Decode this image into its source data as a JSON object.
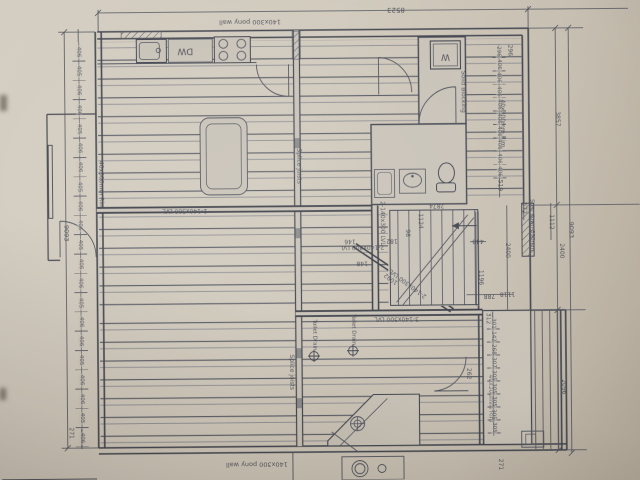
{
  "labels": {
    "pony_wall_top": "140x300 pony wall",
    "pony_wall_bottom": "140x300 pony wall",
    "splice_joists_upper": "Splice joists",
    "splice_joists_lower": "Splice joists",
    "rim_left": "40x300mm Rim",
    "rim_right_upper": "40x300mm Rim",
    "rim_right_lower": "40x300mm Rim",
    "solid_blocking": "Solid Blocking",
    "lvl_beam_mid": "2-140x300 LVL",
    "lvl_beam_stair": "2-140x300 LVL",
    "lvl_beam_vertical": "2-140x300 LVL",
    "lvl_beam_diagonal": "2-140x300 LVL",
    "lvl_beam_triple": "3-140x300 LVL",
    "toilet_drain_left": "Toilet Drain",
    "toilet_drain_right": "Toilet Drain",
    "step_down": "Step down 890mm",
    "dishwasher": "DW",
    "washer": "W"
  },
  "dimensions": {
    "overall_top": "8523",
    "overall_left": "9093",
    "overall_right": "9093",
    "right_upper": "3857",
    "right_mid_inner": "2400",
    "right_mid_outer": "2400",
    "right_lower": "2096",
    "d_296": "296",
    "d_519": "519",
    "d_672": "672",
    "d_1112": "1112",
    "stair_width": "2874",
    "d_1124": "1124",
    "d_182": "182",
    "d_98": "98",
    "d_148": "148",
    "d_146": "146",
    "d_1092": "1092",
    "d_1196": "1196",
    "d_788": "788",
    "d_1118": "1118",
    "d_448": "448",
    "d_312": "312",
    "d_262": "262",
    "left_chain_end": "271",
    "deck_chain_end": "271"
  },
  "left_chain": [
    "406",
    "405",
    "406",
    "406",
    "405",
    "406",
    "406",
    "405",
    "406",
    "406",
    "405",
    "406",
    "406",
    "405",
    "406",
    "406",
    "405",
    "406",
    "406",
    "405",
    "406"
  ],
  "right_chain": [
    "296",
    "406",
    "406",
    "406",
    "406",
    "406",
    "406",
    "406",
    "406",
    "406"
  ],
  "deck_chain": [
    "301",
    "142",
    "268",
    "307",
    "305",
    "305",
    "305",
    "305",
    "305"
  ]
}
